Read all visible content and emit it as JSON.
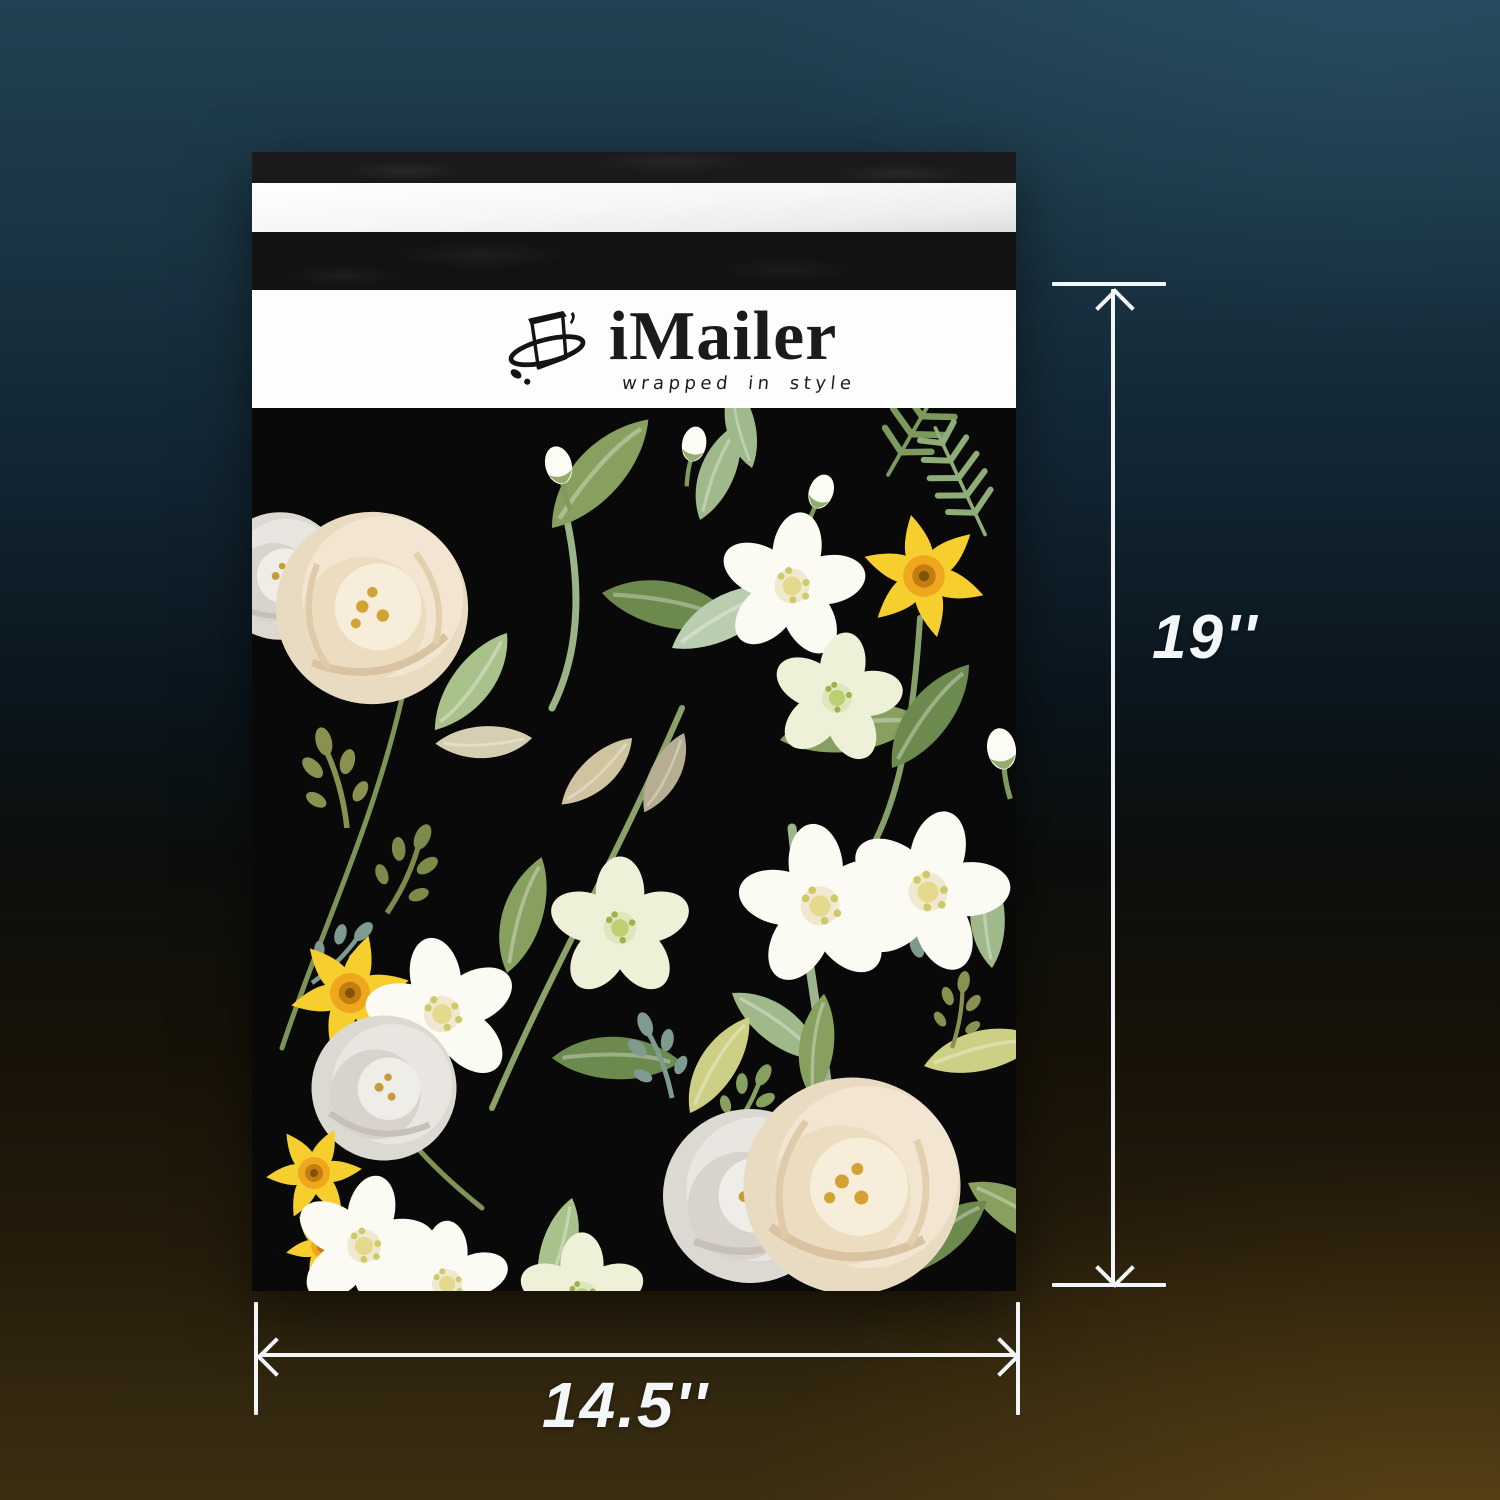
{
  "brand": {
    "name": "iMailer",
    "tagline": "wrapped in style",
    "logo_icon": "ink-parcel-swoosh-icon"
  },
  "measurements": {
    "height_label": "19''",
    "width_label": "14.5''"
  },
  "product": {
    "type": "floral poly mailer envelope",
    "pattern": "white roses, white anemones, yellow daffodils and green leaves on black"
  },
  "colors": {
    "background_teal_top": "#224152",
    "background_black_mid": "#0c0f0d",
    "background_amber_bottom": "#3c2e12",
    "mailer_flap_black": "#1a1a1a",
    "seal_strip_silver": "#f2f2f2",
    "logo_band_white": "#fdfdfd",
    "print_background": "#090909",
    "annotation_white": "#f2f6f8",
    "logo_ink": "#1b1b1b",
    "daffodil_yellow": "#f6cf2f",
    "daffodil_trumpet": "#efa81e",
    "rose_cream": "#f2e6d2",
    "rose_grey": "#e9e6e1",
    "petal_white": "#fbfaf3",
    "hellebore_pale": "#eef1d8",
    "leaf_dark_green": "#6d8a4e",
    "leaf_mid_green": "#87a060",
    "leaf_light_green": "#c3d6a8",
    "leaf_sage": "#9fb98a",
    "leaf_teal": "#7f9a8e",
    "vine_chartreuse": "#cdd084"
  }
}
